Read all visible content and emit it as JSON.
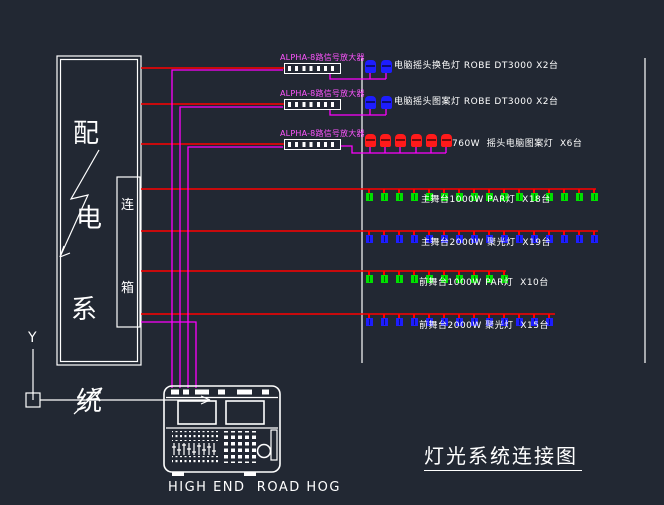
{
  "title": "灯光系统连接图",
  "colors": {
    "background": "#222833",
    "line": "#ffffff",
    "wire_power": "#ff0000",
    "wire_signal": "#ff00ff",
    "fixture_blue": "#1d1dff",
    "fixture_green": "#00e000",
    "fixture_red": "#ff1a1a",
    "label_magenta": "#ff55ff"
  },
  "distribution_box": {
    "label_chars": [
      "配",
      "电",
      "系",
      "统"
    ],
    "junction_chars": [
      "连",
      "箱"
    ]
  },
  "amplifiers": {
    "labels": [
      "ALPHA-8路信号放大器",
      "ALPHA-8路信号放大器",
      "ALPHA-8路信号放大器"
    ]
  },
  "fixture_rows": [
    {
      "id": "row1",
      "type": "moving-head",
      "color": "blue",
      "count": 2,
      "label": "电脑摇头换色灯 ROBE DT3000 X2台"
    },
    {
      "id": "row2",
      "type": "moving-head",
      "color": "blue",
      "count": 2,
      "label": "电脑摇头图案灯 ROBE DT3000 X2台"
    },
    {
      "id": "row3",
      "type": "moving-head",
      "color": "red",
      "count": 6,
      "label": "760W  摇头电脑图案灯  X6台"
    },
    {
      "id": "row4",
      "type": "par",
      "color": "green",
      "count": 16,
      "label": "主舞台1000W PAR灯  X18台"
    },
    {
      "id": "row5",
      "type": "par",
      "color": "blue",
      "count": 16,
      "label": "主舞台2000W 聚光灯  X19台"
    },
    {
      "id": "row6",
      "type": "par",
      "color": "green",
      "count": 10,
      "label": "前舞台1000W PAR灯  X10台"
    },
    {
      "id": "row7",
      "type": "par",
      "color": "blue",
      "count": 13,
      "label": "前舞台2000W 聚光灯  X15台"
    }
  ],
  "console": {
    "label": "HIGH END  ROAD HOG"
  },
  "ucs": {
    "y_label": "Y"
  }
}
